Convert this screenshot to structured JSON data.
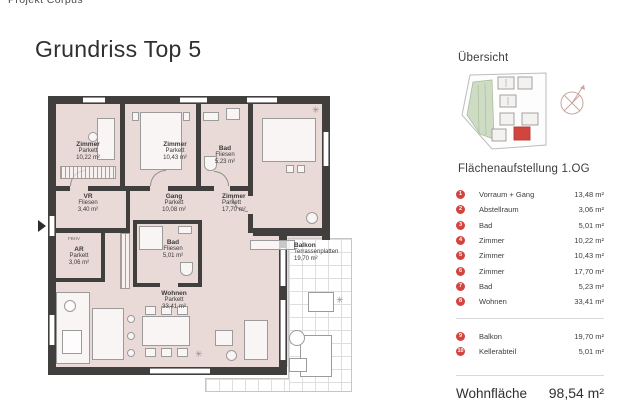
{
  "header": {
    "project": "Projekt Corpus"
  },
  "title": "Grundriss Top 5",
  "plan": {
    "rooms": {
      "zimmer1": {
        "name": "Zimmer",
        "floor": "Parkett",
        "area": "10,22 m²"
      },
      "zimmer2": {
        "name": "Zimmer",
        "floor": "Parkett",
        "area": "10,43 m²"
      },
      "bad1": {
        "name": "Bad",
        "floor": "Fliesen",
        "area": "5,23 m²"
      },
      "zimmer3": {
        "name": "Zimmer",
        "floor": "Parkett",
        "area": "17,70 m²"
      },
      "vr": {
        "name": "VR",
        "floor": "Fliesen",
        "area": "3,40 m²"
      },
      "gang": {
        "name": "Gang",
        "floor": "Parkett",
        "area": "10,08 m²"
      },
      "ar": {
        "name": "AR",
        "floor": "Parkett",
        "area": "3,06 m²"
      },
      "bad2": {
        "name": "Bad",
        "floor": "Fliesen",
        "area": "5,01 m²"
      },
      "wohnen": {
        "name": "Wohnen",
        "floor": "Parkett",
        "area": "33,41 m²"
      },
      "balkon": {
        "name": "Balkon",
        "floor": "Terrassenplatten",
        "area": "19,70 m²"
      }
    },
    "note_fbhv": "FBHV"
  },
  "sidebar": {
    "overview_title": "Übersicht",
    "table_title": "Flächenaufstellung 1.OG",
    "rows": [
      {
        "num": "1",
        "label": "Vorraum + Gang",
        "value": "13,48 m²"
      },
      {
        "num": "2",
        "label": "Abstellraum",
        "value": "3,06 m²"
      },
      {
        "num": "3",
        "label": "Bad",
        "value": "5,01 m²"
      },
      {
        "num": "4",
        "label": "Zimmer",
        "value": "10,22 m²"
      },
      {
        "num": "5",
        "label": "Zimmer",
        "value": "10,43 m²"
      },
      {
        "num": "6",
        "label": "Zimmer",
        "value": "17,70 m²"
      },
      {
        "num": "7",
        "label": "Bad",
        "value": "5,23 m²"
      },
      {
        "num": "8",
        "label": "Wohnen",
        "value": "33,41 m²"
      }
    ],
    "extra_rows": [
      {
        "num": "9",
        "label": "Balkon",
        "value": "19,70 m²"
      },
      {
        "num": "10",
        "label": "Kellerabteil",
        "value": "5,01 m²"
      }
    ],
    "total_label": "Wohnfläche",
    "total_value": "98,54 m²"
  },
  "colors": {
    "accent_red": "#d2453e",
    "room_fill": "#e9dad8",
    "wall": "#413f3e",
    "site_green": "#cfdcc4"
  }
}
